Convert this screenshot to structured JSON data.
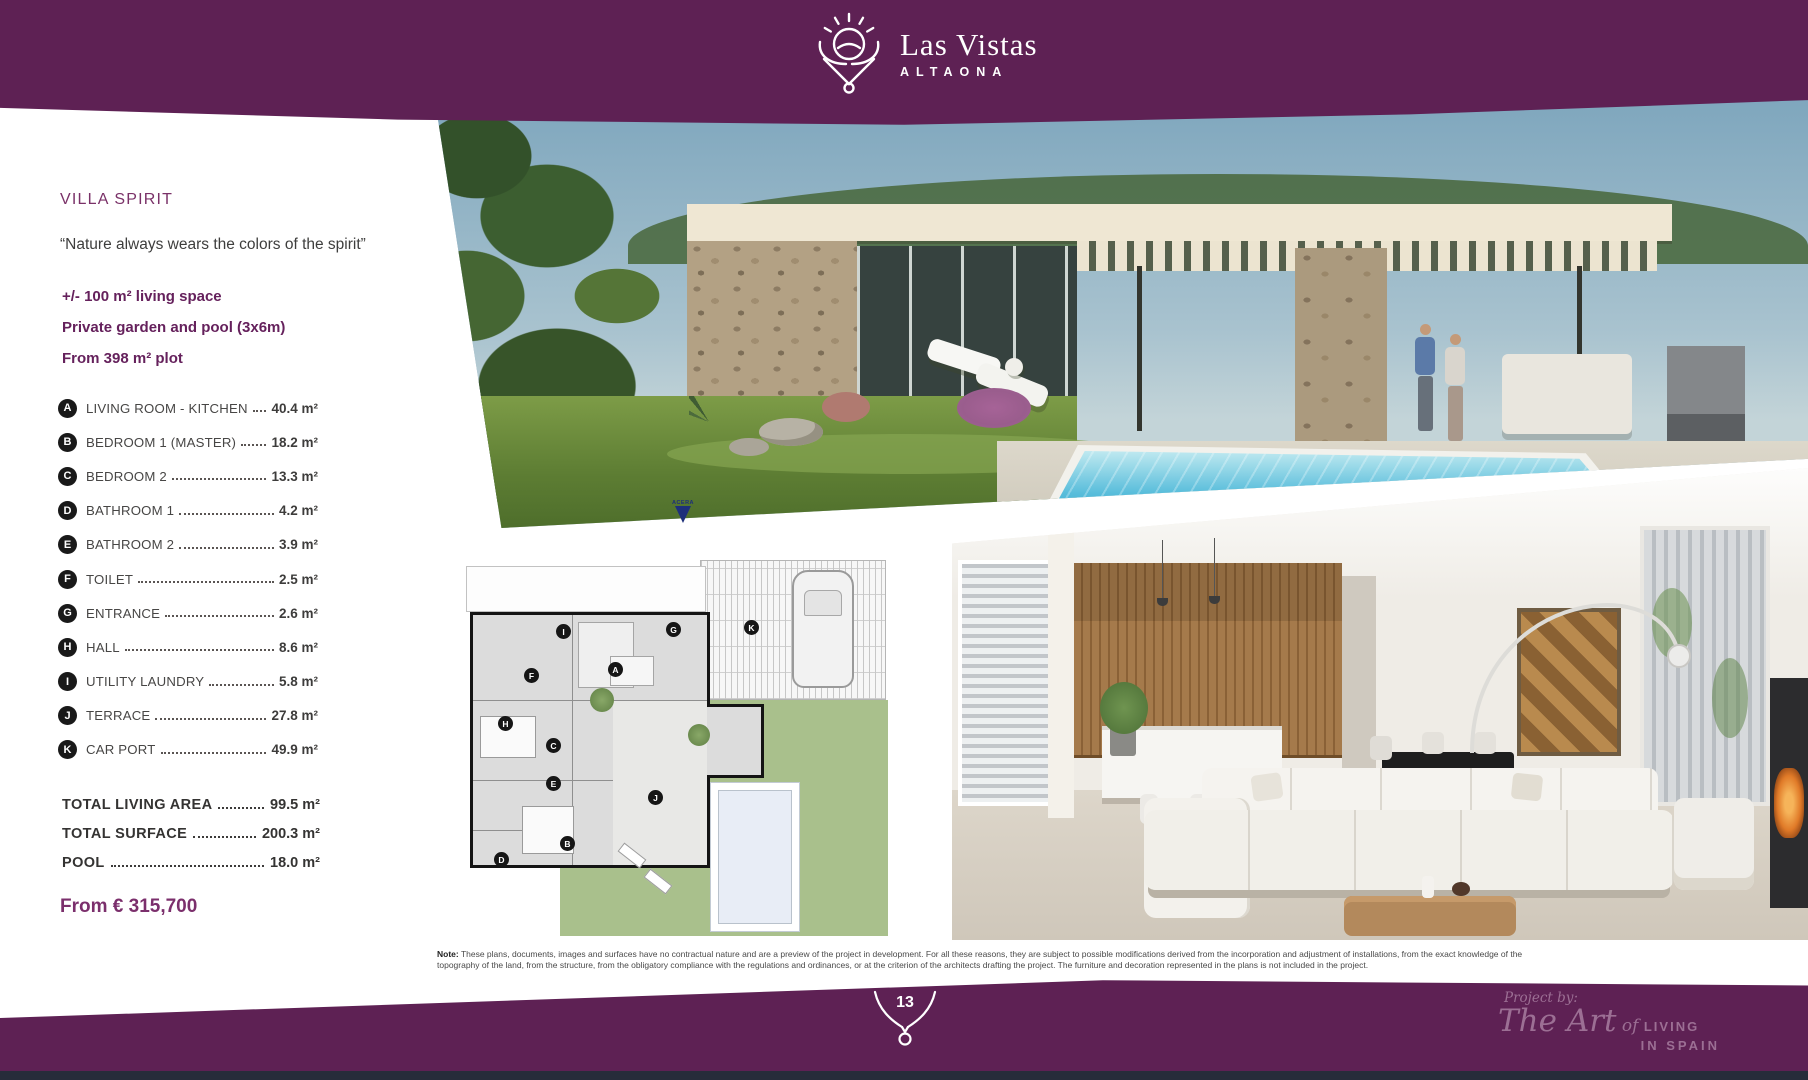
{
  "theme": {
    "brand_purple": "#5e2154",
    "accent_purple": "#7b2f6c",
    "navy_strip": "#272c3a",
    "plan_marker_navy": "#1d2f7a"
  },
  "header": {
    "brand": "Las Vistas",
    "brand_sub": "ALTAONA"
  },
  "sidebar": {
    "title": "VILLA SPIRIT",
    "quote": "“Nature always wears the colors of the spirit”",
    "highlights": [
      "+/- 100 m² living space",
      "Private garden and pool (3x6m)",
      "From 398 m² plot"
    ],
    "rooms": [
      {
        "key": "A",
        "label": "LIVING ROOM - KITCHEN",
        "area": "40.4 m²"
      },
      {
        "key": "B",
        "label": "BEDROOM 1 (MASTER)",
        "area": "18.2 m²"
      },
      {
        "key": "C",
        "label": "BEDROOM 2",
        "area": "13.3 m²"
      },
      {
        "key": "D",
        "label": "BATHROOM 1",
        "area": "4.2 m²"
      },
      {
        "key": "E",
        "label": "BATHROOM 2",
        "area": "3.9 m²"
      },
      {
        "key": "F",
        "label": "TOILET",
        "area": "2.5 m²"
      },
      {
        "key": "G",
        "label": "ENTRANCE",
        "area": "2.6 m²"
      },
      {
        "key": "H",
        "label": "HALL",
        "area": "8.6 m²"
      },
      {
        "key": "I",
        "label": "UTILITY LAUNDRY",
        "area": "5.8 m²"
      },
      {
        "key": "J",
        "label": "TERRACE",
        "area": "27.8 m²"
      },
      {
        "key": "K",
        "label": "CAR PORT",
        "area": "49.9 m²"
      }
    ],
    "totals": [
      {
        "label": "TOTAL LIVING AREA",
        "area": "99.5 m²"
      },
      {
        "label": "TOTAL SURFACE",
        "area": "200.3 m²"
      },
      {
        "label": "POOL",
        "area": "18.0 m²"
      }
    ],
    "price": "From € 315,700"
  },
  "plan": {
    "marker_label": "ACERA"
  },
  "note": {
    "label": "Note:",
    "text": " These plans, documents, images and surfaces have no contractual nature and are a preview of the project in development. For all these reasons, they are subject to possible modifications derived from the incorporation and adjustment of installations, from the exact knowledge of the topography of the land, from the structure, from the obligatory compliance with the regulations and ordinances, or at the criterion of the architects drafting the project. The furniture and decoration represented in the plans is not included in the project."
  },
  "footer": {
    "page_number": "13",
    "project_by": "Project by:",
    "logo": {
      "part1": "The Art",
      "part2": " of ",
      "part3": "LIVING",
      "part4": "IN SPAIN"
    }
  }
}
